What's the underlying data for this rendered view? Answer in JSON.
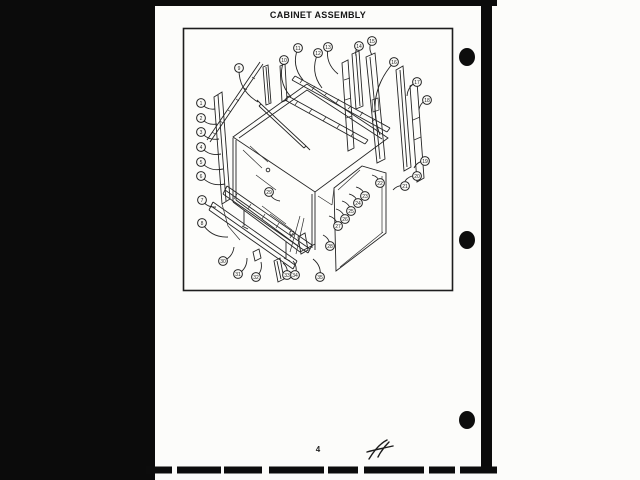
{
  "page": {
    "title": "CABINET ASSEMBLY",
    "page_number": "4",
    "handwritten_mark": "A-1"
  },
  "colors": {
    "ink": "#242424",
    "paper": "#fbfbf8",
    "margin_black": "#0b0b0b"
  },
  "diagram": {
    "name": "cabinet-assembly-exploded-view",
    "callouts": [
      {
        "label": "1",
        "x": 201,
        "y": 103,
        "tx": 215,
        "ty": 109
      },
      {
        "label": "2",
        "x": 201,
        "y": 118,
        "tx": 217,
        "ty": 124
      },
      {
        "label": "3",
        "x": 201,
        "y": 132,
        "tx": 219,
        "ty": 139
      },
      {
        "label": "4",
        "x": 201,
        "y": 147,
        "tx": 221,
        "ty": 154
      },
      {
        "label": "5",
        "x": 201,
        "y": 162,
        "tx": 223,
        "ty": 169
      },
      {
        "label": "6",
        "x": 201,
        "y": 176,
        "tx": 225,
        "ty": 184
      },
      {
        "label": "7",
        "x": 202,
        "y": 200,
        "tx": 216,
        "ty": 207
      },
      {
        "label": "8",
        "x": 202,
        "y": 223,
        "tx": 228,
        "ty": 237
      },
      {
        "label": "9",
        "x": 239,
        "y": 68,
        "tx": 258,
        "ty": 102
      },
      {
        "label": "10",
        "x": 284,
        "y": 60,
        "tx": 291,
        "ty": 97
      },
      {
        "label": "11",
        "x": 298,
        "y": 48,
        "tx": 303,
        "ty": 80
      },
      {
        "label": "12",
        "x": 318,
        "y": 53,
        "tx": 322,
        "ty": 88
      },
      {
        "label": "13",
        "x": 328,
        "y": 47,
        "tx": 338,
        "ty": 74
      },
      {
        "label": "14",
        "x": 359,
        "y": 46,
        "tx": 356,
        "ty": 56
      },
      {
        "label": "15",
        "x": 372,
        "y": 41,
        "tx": 372,
        "ty": 55
      },
      {
        "label": "16",
        "x": 394,
        "y": 62,
        "tx": 380,
        "ty": 135
      },
      {
        "label": "17",
        "x": 417,
        "y": 82,
        "tx": 407,
        "ty": 96
      },
      {
        "label": "18",
        "x": 427,
        "y": 100,
        "tx": 419,
        "ty": 110
      },
      {
        "label": "19",
        "x": 425,
        "y": 161,
        "tx": 414,
        "ty": 168
      },
      {
        "label": "20",
        "x": 417,
        "y": 176,
        "tx": 405,
        "ty": 181
      },
      {
        "label": "21",
        "x": 405,
        "y": 186,
        "tx": 393,
        "ty": 190
      },
      {
        "label": "22",
        "x": 380,
        "y": 183,
        "tx": 372,
        "ty": 175
      },
      {
        "label": "23",
        "x": 365,
        "y": 196,
        "tx": 356,
        "ty": 187
      },
      {
        "label": "24",
        "x": 358,
        "y": 203,
        "tx": 349,
        "ty": 194
      },
      {
        "label": "25",
        "x": 351,
        "y": 211,
        "tx": 342,
        "ty": 201
      },
      {
        "label": "26",
        "x": 345,
        "y": 219,
        "tx": 336,
        "ty": 209
      },
      {
        "label": "27",
        "x": 338,
        "y": 226,
        "tx": 329,
        "ty": 216
      },
      {
        "label": "28",
        "x": 330,
        "y": 246,
        "tx": 323,
        "ty": 235
      },
      {
        "label": "29",
        "x": 269,
        "y": 192,
        "tx": 280,
        "ty": 201
      },
      {
        "label": "30",
        "x": 223,
        "y": 261,
        "tx": 234,
        "ty": 247
      },
      {
        "label": "31",
        "x": 238,
        "y": 274,
        "tx": 247,
        "ty": 258
      },
      {
        "label": "32",
        "x": 256,
        "y": 277,
        "tx": 261,
        "ty": 262
      },
      {
        "label": "33",
        "x": 287,
        "y": 275,
        "tx": 283,
        "ty": 263
      },
      {
        "label": "34",
        "x": 295,
        "y": 275,
        "tx": 293,
        "ty": 261
      },
      {
        "label": "35",
        "x": 320,
        "y": 277,
        "tx": 313,
        "ty": 259
      }
    ]
  }
}
